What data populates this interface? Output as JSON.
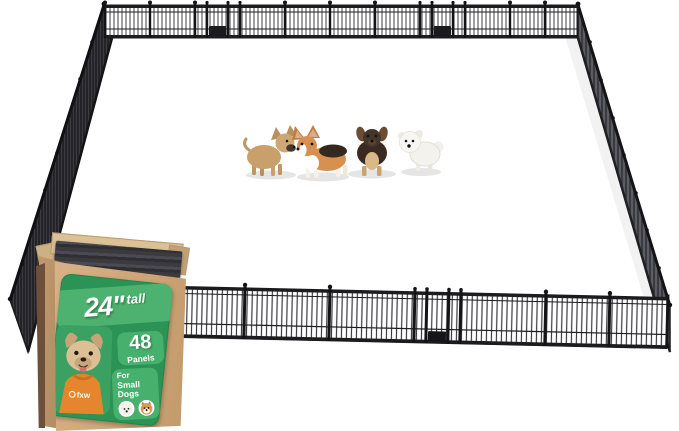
{
  "background": "#FFFFFF",
  "product_box": {
    "label": {
      "size": "24\"",
      "size_suffix": "tall",
      "panel_count": "48",
      "panel_count_caption": "Panels",
      "audience_line1": "For",
      "audience_line2": "Small Dogs",
      "brand": "fxw"
    },
    "colors": {
      "cardboard": "#CFA87A",
      "cardboard_shadow": "#6E4F3C",
      "label_green": "#2A9355",
      "label_tile_green": "#46B06C",
      "shirt_orange": "#E5862F",
      "packed_panels": "#39393D"
    }
  },
  "playpen": {
    "metal_color": "#1B1B1D",
    "dogs": [
      {
        "name": "fawn chihuahua",
        "color": "#C9A06C"
      },
      {
        "name": "corgi",
        "color": "#D89050"
      },
      {
        "name": "dachshund",
        "color": "#3A2B20"
      },
      {
        "name": "bichon frise",
        "color": "#F4F2ED"
      }
    ]
  }
}
